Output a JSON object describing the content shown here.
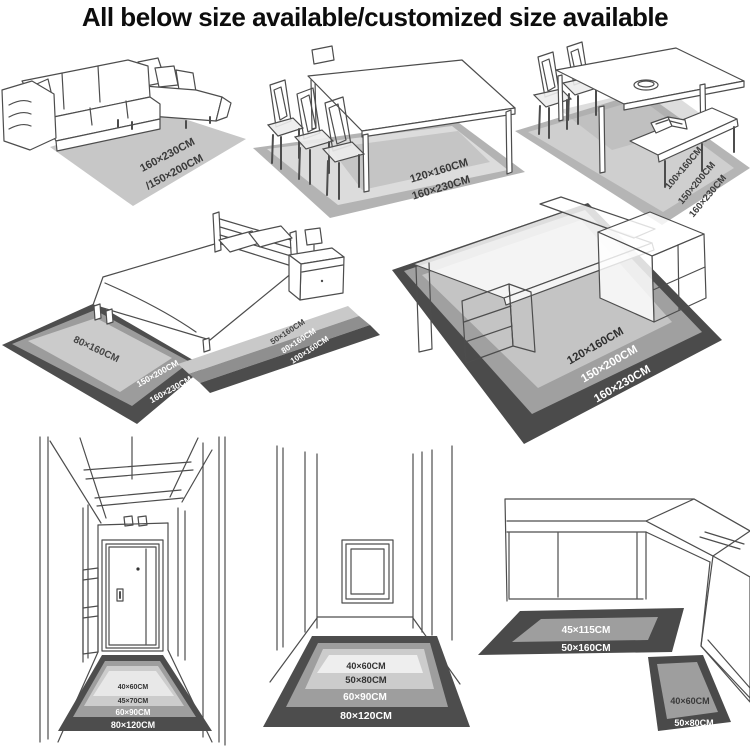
{
  "title": "All below size available/customized size available",
  "colors": {
    "rug_dark": "#4a4a4a",
    "rug_mid": "#9e9e9e",
    "rug_light": "#c9c9c9",
    "rug_pale": "#e8e8e8",
    "line_art": "#4d4d4d",
    "label_dark": "#3a3a3a",
    "label_light": "#ffffff"
  },
  "scenes": {
    "living_room_sofa": {
      "rug_sizes": [
        "160×230CM",
        "/150×200CM"
      ]
    },
    "dining_table": {
      "rug_sizes": [
        "120×160CM",
        "160×230CM"
      ]
    },
    "dining_bench": {
      "rug_sizes": [
        "100×160CM",
        "150×200CM",
        "160×230CM"
      ]
    },
    "bedroom": {
      "bed_rug_inner": "80×160CM",
      "bed_rug_border": [
        "150×200CM",
        "160×230CM"
      ],
      "runner_sizes": [
        "50×160CM",
        "80×160CM",
        "100×160CM"
      ]
    },
    "office_desk": {
      "rug_sizes": [
        "120×160CM",
        "150×200CM",
        "160×230CM"
      ]
    },
    "entry_hallway": {
      "mat_sizes": [
        "40×60CM",
        "45×70CM",
        "60×90CM",
        "80×120CM"
      ]
    },
    "corridor": {
      "mat_sizes": [
        "40×60CM",
        "50×80CM",
        "60×90CM",
        "80×120CM"
      ]
    },
    "kitchen": {
      "runner_sizes": [
        "45×115CM",
        "50×160CM"
      ],
      "mat_sizes": [
        "40×60CM",
        "50×80CM"
      ]
    }
  }
}
